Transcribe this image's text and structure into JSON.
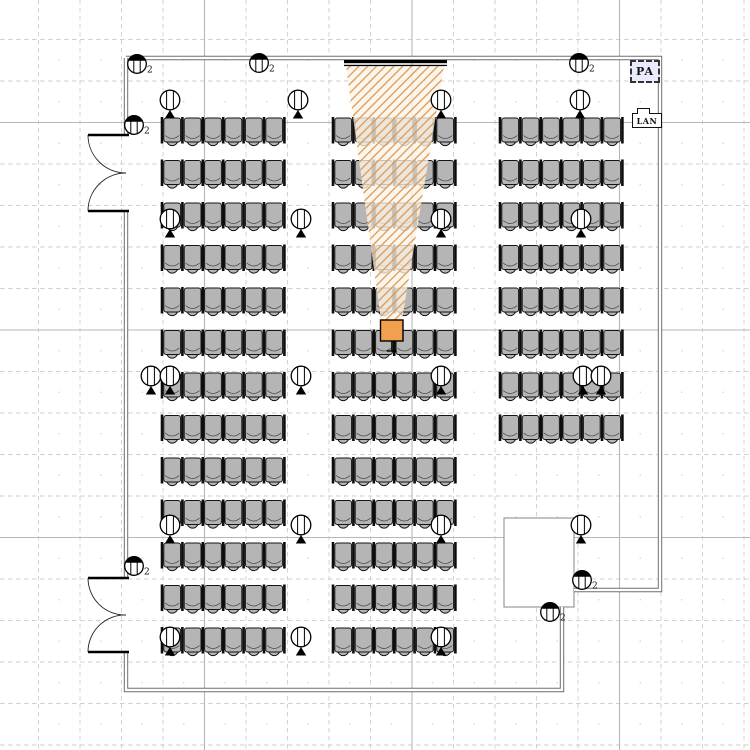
{
  "labels": {
    "pa": "PA",
    "lan": "LAN",
    "outlet_sub": "2"
  },
  "palette": {
    "bg": "#ffffff",
    "grid_minor": "#cfcfcf",
    "grid_major": "#b7b7b7",
    "grid_dot": "#c9c9c9",
    "wall": "#6e6e6e",
    "wall_core": "#ffffff",
    "door": "#000000",
    "chair_fill": "#b5b5b5",
    "chair_stroke": "#141414",
    "chair_seatline": "#444444",
    "cone_fill": "#fdf3e7",
    "cone_hatch": "#db9a55",
    "screen": "#000000",
    "projector_fill": "#f2a04e",
    "symbol_stroke": "#000000",
    "booth_stroke": "#9a9a9a"
  },
  "canvas": {
    "width": 750,
    "height": 750
  },
  "grid": {
    "pitch": 41.5,
    "x0": 38.5,
    "y0": 39.5,
    "major_x": [
      204.5,
      412,
      619.5
    ],
    "major_y": [
      122.5,
      330,
      537.5
    ]
  },
  "room": {
    "wall_segments": [
      [
        [
          126,
          58
        ],
        [
          660,
          58
        ],
        [
          660,
          590
        ],
        [
          574,
          590
        ]
      ],
      [
        [
          562,
          607
        ],
        [
          562,
          690
        ],
        [
          126,
          690
        ],
        [
          126,
          652
        ]
      ],
      [
        [
          126,
          578
        ],
        [
          126,
          211
        ]
      ],
      [
        [
          126,
          135
        ],
        [
          126,
          58
        ]
      ]
    ],
    "booth": {
      "x": 504,
      "y": 518,
      "w": 70,
      "h": 89
    },
    "doors": [
      {
        "wall_x": 126,
        "tip_x": 88,
        "top": 135,
        "bottom": 211
      },
      {
        "wall_x": 126,
        "tip_x": 88,
        "top": 578,
        "bottom": 652
      }
    ]
  },
  "seating": {
    "chair_pitch": 20.4,
    "row_pitch": 42.5,
    "row_y0": 118,
    "cols": 6,
    "chair_h": 24,
    "blocks": [
      {
        "name": "left",
        "x": 162,
        "rows": 13
      },
      {
        "name": "center",
        "x": 333,
        "rows": 13
      },
      {
        "name": "right",
        "x": 500,
        "rows": 8
      }
    ]
  },
  "projection": {
    "screen": {
      "x": 344,
      "y": 60,
      "w": 103
    },
    "cone": [
      [
        346,
        66
      ],
      [
        444,
        66
      ],
      [
        402,
        320
      ],
      [
        381,
        320
      ]
    ],
    "projector": {
      "x": 380.5,
      "y": 320,
      "w": 22.5,
      "h": 21
    }
  },
  "symbols": {
    "speakers": [
      [
        170,
        100
      ],
      [
        298,
        100
      ],
      [
        441,
        100
      ],
      [
        580,
        100
      ],
      [
        170,
        219
      ],
      [
        301,
        219
      ],
      [
        441,
        219
      ],
      [
        581,
        219
      ],
      [
        151,
        376
      ],
      [
        170,
        376
      ],
      [
        301,
        376
      ],
      [
        441,
        376
      ],
      [
        583,
        376
      ],
      [
        601,
        376
      ],
      [
        170,
        525
      ],
      [
        301,
        525
      ],
      [
        441,
        525
      ],
      [
        581,
        525
      ],
      [
        170,
        637
      ],
      [
        301,
        637
      ],
      [
        441,
        637
      ]
    ],
    "outlets": [
      [
        137,
        64
      ],
      [
        259,
        63
      ],
      [
        579,
        63
      ],
      [
        134,
        125
      ],
      [
        134,
        566
      ],
      [
        582,
        580
      ],
      [
        550,
        612
      ]
    ]
  }
}
